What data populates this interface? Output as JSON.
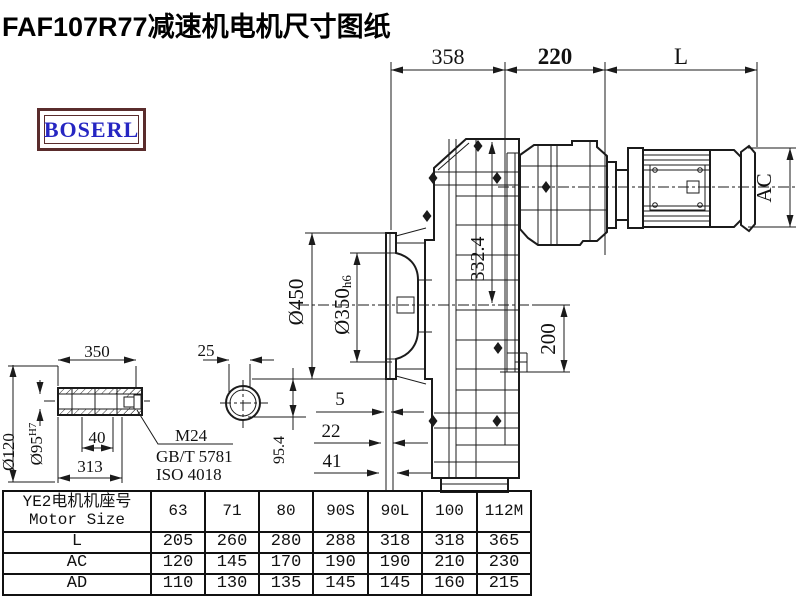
{
  "title": "FAF107R77减速机电机尺寸图纸",
  "logo": "BOSERL",
  "drawing": {
    "dims": {
      "overall_left": "358",
      "overall_mid": "220",
      "overall_right": "L",
      "motor_diameter": "AC",
      "flange_od": "Ø450",
      "spigot": "Ø350",
      "spigot_tol": "h6",
      "height_332": "332.4",
      "axis_height": "200",
      "offset_5": "5",
      "offset_22": "22",
      "offset_41": "41",
      "height_95": "95.4"
    },
    "shaft": {
      "length": "350",
      "key_width": "25",
      "od": "Ø120",
      "bore": "Ø95",
      "bore_tol": "H7",
      "step": "40",
      "length_313": "313",
      "bolt": "M24",
      "standard_gb": "GB/T 5781",
      "standard_iso": "ISO 4018"
    }
  },
  "table": {
    "header_cn": "YE2电机机座号",
    "header_en": "Motor Size",
    "columns": [
      "63",
      "71",
      "80",
      "90S",
      "90L",
      "100",
      "112M"
    ],
    "rows": [
      {
        "label": "L",
        "values": [
          "205",
          "260",
          "280",
          "288",
          "318",
          "318",
          "365"
        ]
      },
      {
        "label": "AC",
        "values": [
          "120",
          "145",
          "170",
          "190",
          "190",
          "210",
          "230"
        ]
      },
      {
        "label": "AD",
        "values": [
          "110",
          "130",
          "135",
          "145",
          "145",
          "160",
          "215"
        ]
      }
    ]
  }
}
